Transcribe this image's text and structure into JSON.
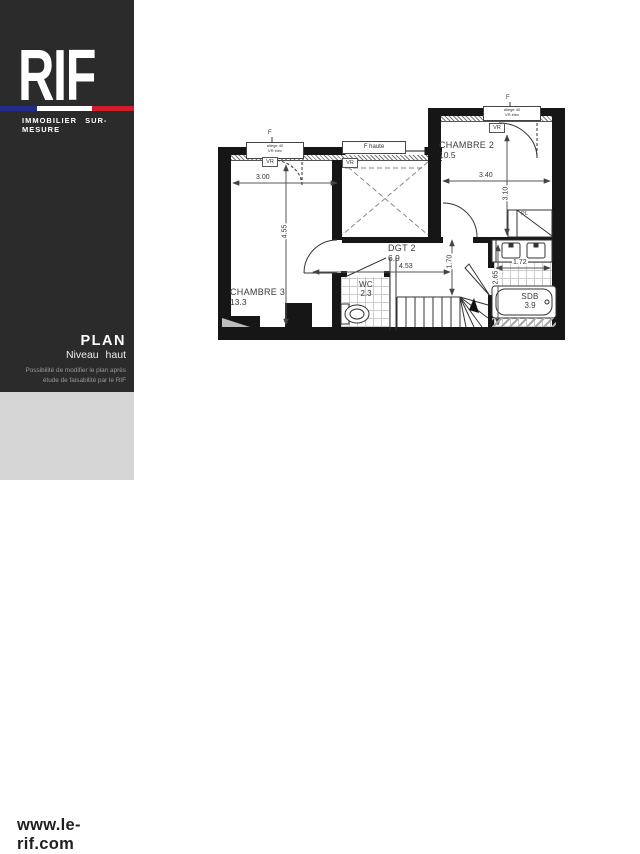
{
  "sidebar": {
    "brand": {
      "name": "RIF",
      "tagline": "IMMOBILIER SUR-MESURE"
    },
    "flag_colors": {
      "blue": "#232a8e",
      "white": "#ffffff",
      "red": "#cf1c2b"
    },
    "plan_block": {
      "title": "PLAN",
      "subtitle": "Niveau haut",
      "note_line1": "Possibilité de modifier le plan après",
      "note_line2": "étude de faisabilité par le RIF"
    },
    "website": "www.le-rif.com",
    "colors": {
      "dark_bg": "#2b2b2b",
      "light_bg": "#d5d5d5"
    }
  },
  "plan": {
    "rooms": {
      "chambre2": {
        "name": "CHAMBRE 2",
        "area": "10.5"
      },
      "chambre3": {
        "name": "CHAMBRE 3",
        "area": "13.3"
      },
      "dgt2": {
        "name": "DGT 2",
        "area": "6.9"
      },
      "wc": {
        "name": "WC",
        "area": "2.3"
      },
      "sdb": {
        "name": "SDB",
        "area": "3.9"
      },
      "placard": {
        "label": "PL"
      }
    },
    "dimensions": {
      "d300": "3.00",
      "d455": "4.55",
      "d340": "3.40",
      "d310": "3.10",
      "d453": "4.53",
      "d170": "1.70",
      "d172": "1.72",
      "d265": "2.65"
    },
    "windows": {
      "w1_line1": "allège 40",
      "w1_line2": "VR élec",
      "f_haute": "F haute",
      "w2_line1": "allège 40",
      "w2_line2": "VR élec",
      "vr": "VR",
      "f_mark": "F"
    }
  }
}
